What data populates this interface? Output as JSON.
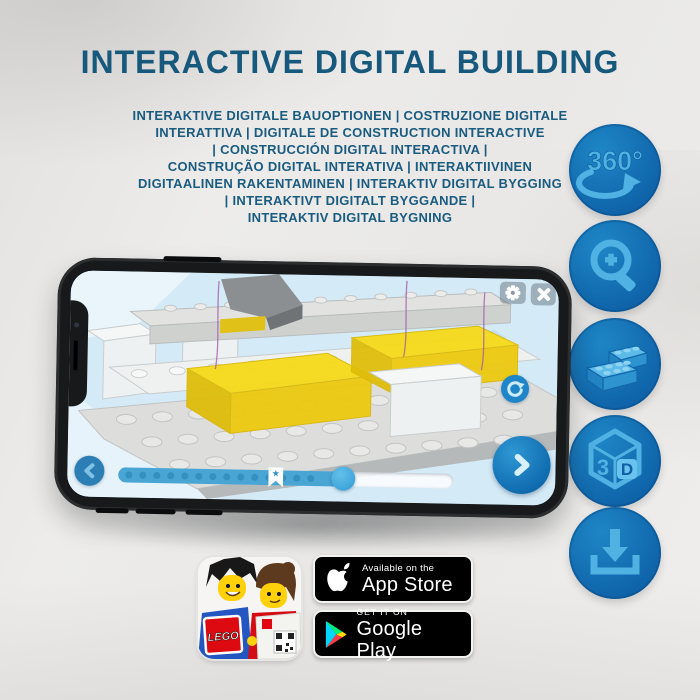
{
  "header": {
    "title": "INTERACTIVE DIGITAL BUILDING",
    "title_color": "#17587d",
    "subtitle_lines": [
      "INTERAKTIVE DIGITALE BAUOPTIONEN | COSTRUZIONE DIGITALE",
      "INTERATTIVA | DIGITALE DE CONSTRUCTION INTERACTIVE",
      "| CONSTRUCCIÓN DIGITAL INTERACTIVA |",
      "CONSTRUÇÃO DIGITAL INTERATIVA | INTERAKTIIVINEN",
      "DIGITAALINEN RAKENTAMINEN | INTERAKTIV DIGITAL BYGGING",
      "| INTERAKTIVT DIGITALT BYGGANDE |",
      "INTERAKTIV DIGITAL BYGNING"
    ]
  },
  "feature_icons": {
    "circle_color": "#1478bd",
    "glyph_color": "#4fb2e2",
    "items": [
      {
        "name": "rotate-360-icon",
        "label": "360°"
      },
      {
        "name": "zoom-in-icon"
      },
      {
        "name": "bricks-icon"
      },
      {
        "name": "cube-3d-icon",
        "label_left": "3",
        "label_right": "D"
      },
      {
        "name": "download-icon"
      }
    ]
  },
  "phone": {
    "screen": {
      "toolbar_icons": [
        "settings-gear-icon",
        "close-icon"
      ],
      "side_button": "reset-rotation-button",
      "nav_buttons": [
        "previous-step-button",
        "next-step-button"
      ],
      "slider": {
        "progress_percent": 67,
        "marker_glyph": "★"
      },
      "brick_accent_color": "#f3d318",
      "ui_blue": "#49a5d3"
    }
  },
  "badges": {
    "lego_app": {
      "logo_text": "LEGO"
    },
    "app_store": {
      "line1": "Available on the",
      "line2": "App Store"
    },
    "google_play": {
      "line1": "GET IT ON",
      "line2": "Google Play"
    }
  }
}
